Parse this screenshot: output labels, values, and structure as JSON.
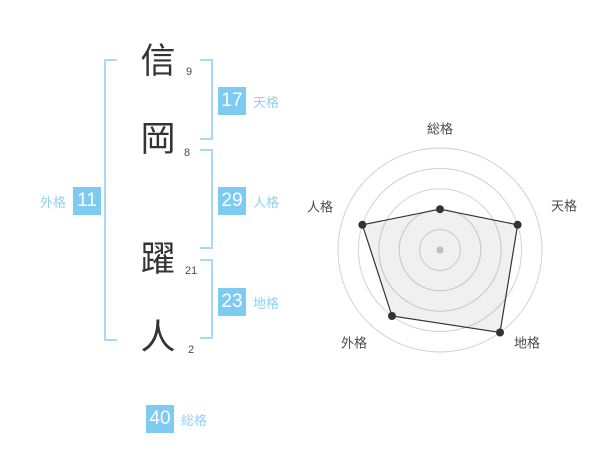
{
  "name_analysis": {
    "characters": [
      {
        "char": "信",
        "strokes": "9"
      },
      {
        "char": "岡",
        "strokes": "8"
      },
      {
        "char": "躍",
        "strokes": "21"
      },
      {
        "char": "人",
        "strokes": "2"
      }
    ],
    "badges": {
      "tenkaku": {
        "value": "17",
        "label": "天格"
      },
      "jinkaku": {
        "value": "29",
        "label": "人格"
      },
      "chikaku": {
        "value": "23",
        "label": "地格"
      },
      "gaikaku": {
        "value": "11",
        "label": "外格"
      },
      "soukaku": {
        "value": "40",
        "label": "総格"
      }
    }
  },
  "chart_data": {
    "type": "radar",
    "axes": [
      "総格",
      "天格",
      "地格",
      "外格",
      "人格"
    ],
    "values": [
      2,
      4,
      5,
      4,
      4
    ],
    "max": 5,
    "rings": 5,
    "grid": true,
    "legend_position": "none",
    "start_angle_deg": -90,
    "clockwise": true
  },
  "colors": {
    "badge_bg": "#7ecbf2",
    "badge_text": "#ffffff",
    "label_text": "#8fd2f5",
    "bracket": "#a8daf6",
    "kanji": "#333333",
    "stroke_num": "#4d4d4d",
    "ring": "#d2d2d2",
    "polygon_stroke": "#333333",
    "polygon_fill": "rgba(0,0,0,0.06)",
    "dot": "#333333",
    "center_dot": "#bdbdbd",
    "axis_label": "#4a4a4a"
  }
}
